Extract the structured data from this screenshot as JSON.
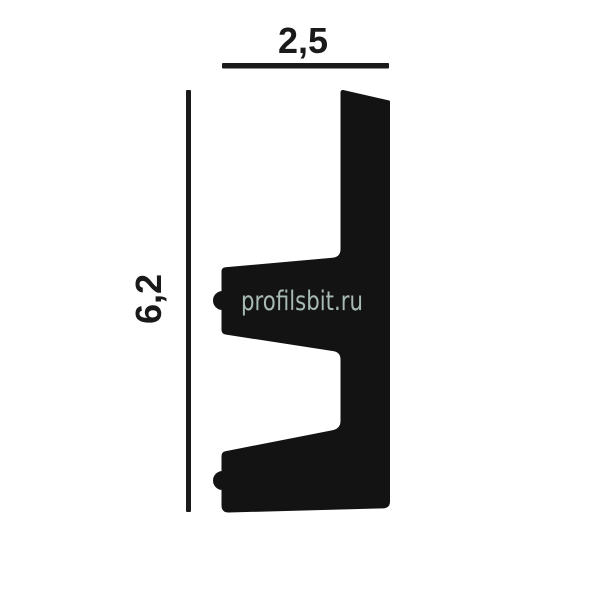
{
  "diagram": {
    "type": "molding-profile-cross-section",
    "width_label": "2,5",
    "height_label": "6,2",
    "watermark": "profilsbit.ru",
    "colors": {
      "profile": "#131313",
      "dimension": "#1a1a1a",
      "watermark": "#a8bab4",
      "background": "#ffffff"
    }
  }
}
